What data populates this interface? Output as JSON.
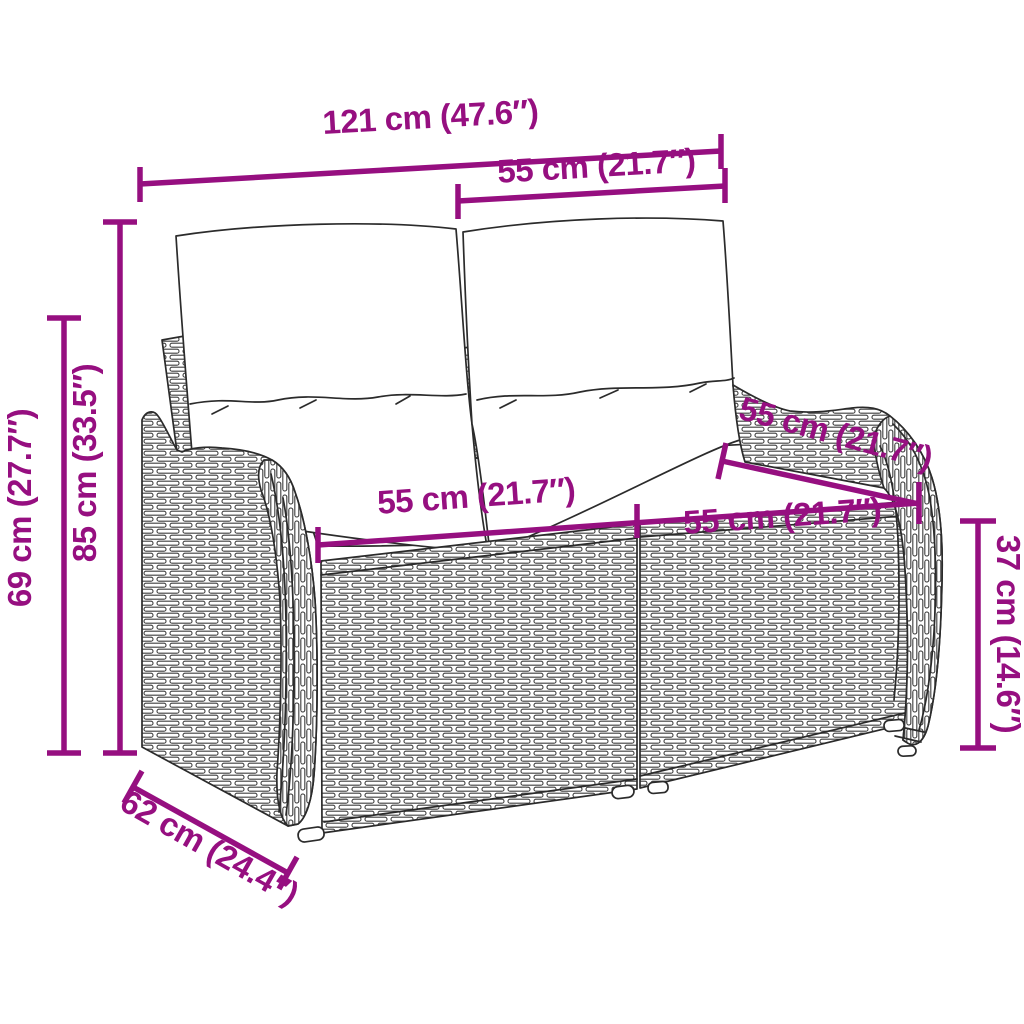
{
  "colors": {
    "accent": "#960f80",
    "line": "#2b2b2b",
    "wicker": "#3f3f3f",
    "background": "#ffffff",
    "cushion": "#ffffff"
  },
  "dimensions": {
    "overall_width": {
      "label": "121 cm (47.6″)"
    },
    "backrest_cushion_width": {
      "label": "55 cm (21.7″)"
    },
    "overall_height": {
      "label": "85 cm (33.5″)"
    },
    "side_height": {
      "label": "69 cm (27.7″)"
    },
    "seat_section_back_width": {
      "label": "55 cm (21.7″)"
    },
    "seat_width_left": {
      "label": "55 cm (21.7″)"
    },
    "seat_width_right": {
      "label": "55 cm (21.7″)"
    },
    "seat_height": {
      "label": "37 cm (14.6″)"
    },
    "seat_depth": {
      "label": "62 cm (24.4″)"
    }
  }
}
